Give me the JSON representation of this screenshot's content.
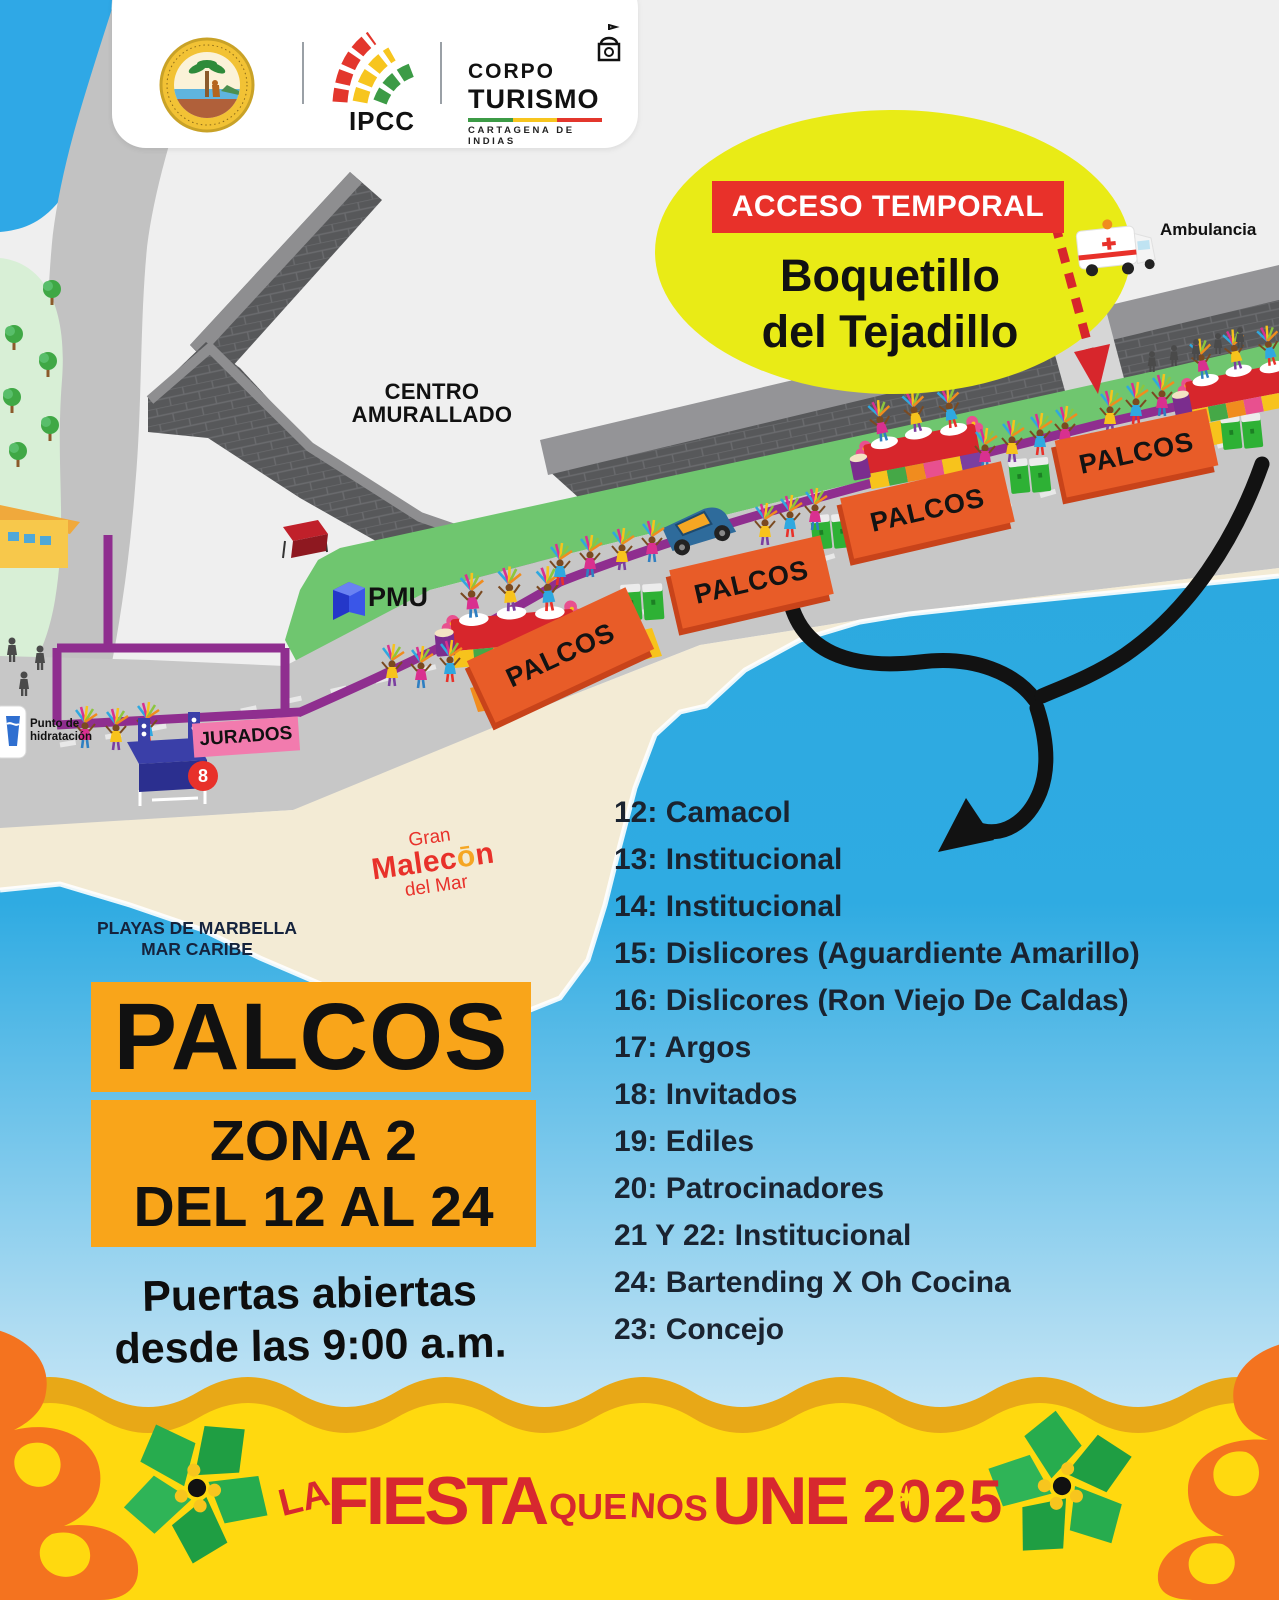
{
  "header": {
    "seal_alt": "Distrito de Cartagena de Indias",
    "ipcc": "IPCC",
    "corpo_line1": "CORPO",
    "corpo_line2": "TURISMO",
    "corpo_subtitle": "CARTAGENA DE INDIAS"
  },
  "access": {
    "banner": "ACCESO TEMPORAL",
    "place_line1": "Boquetillo",
    "place_line2": "del Tejadillo",
    "ambulance_label": "Ambulancia"
  },
  "map": {
    "centro_line1": "CENTRO",
    "centro_line2": "AMURALLADO",
    "pmu": "PMU",
    "jurados": "JURADOS",
    "stage_number": "8",
    "hydration_line1": "Punto de",
    "hydration_line2": "hidratación",
    "palcos_sign": "PALCOS",
    "malecon_line1": "Gran",
    "malecon_pre": "Malec",
    "malecon_o": "ō",
    "malecon_post": "n",
    "malecon_line3": "del Mar",
    "playas_line1": "PLAYAS DE MARBELLA",
    "playas_line2": "MAR CARIBE"
  },
  "panel": {
    "title": "PALCOS",
    "zona": "ZONA 2",
    "rango": "DEL 12 AL 24",
    "doors_line1": "Puertas abiertas",
    "doors_line2": "desde las 9:00 a.m."
  },
  "palcos": {
    "items": [
      "12: Camacol",
      "13: Institucional",
      "14: Institucional",
      "15: Dislicores (Aguardiente Amarillo)",
      "16: Dislicores (Ron Viejo De Caldas)",
      "17: Argos",
      "18: Invitados",
      "19: Ediles",
      "20: Patrocinadores",
      "21 Y 22: Institucional",
      "24: Bartending X Oh Cocina",
      "23: Concejo"
    ]
  },
  "footer": {
    "word1": "LA",
    "word2": "FIESTA",
    "word3": "QUE",
    "word4": "NOS",
    "word5": "UNE",
    "year": "2025",
    "star": "✶"
  },
  "colors": {
    "accent_red": "#E8312A",
    "poster_yellow": "#FFD90F",
    "sign_orange": "#E85C28",
    "panel_orange": "#F9A51A",
    "route_purple": "#8F2E8F",
    "sea_blue": "#2CA9E0"
  }
}
